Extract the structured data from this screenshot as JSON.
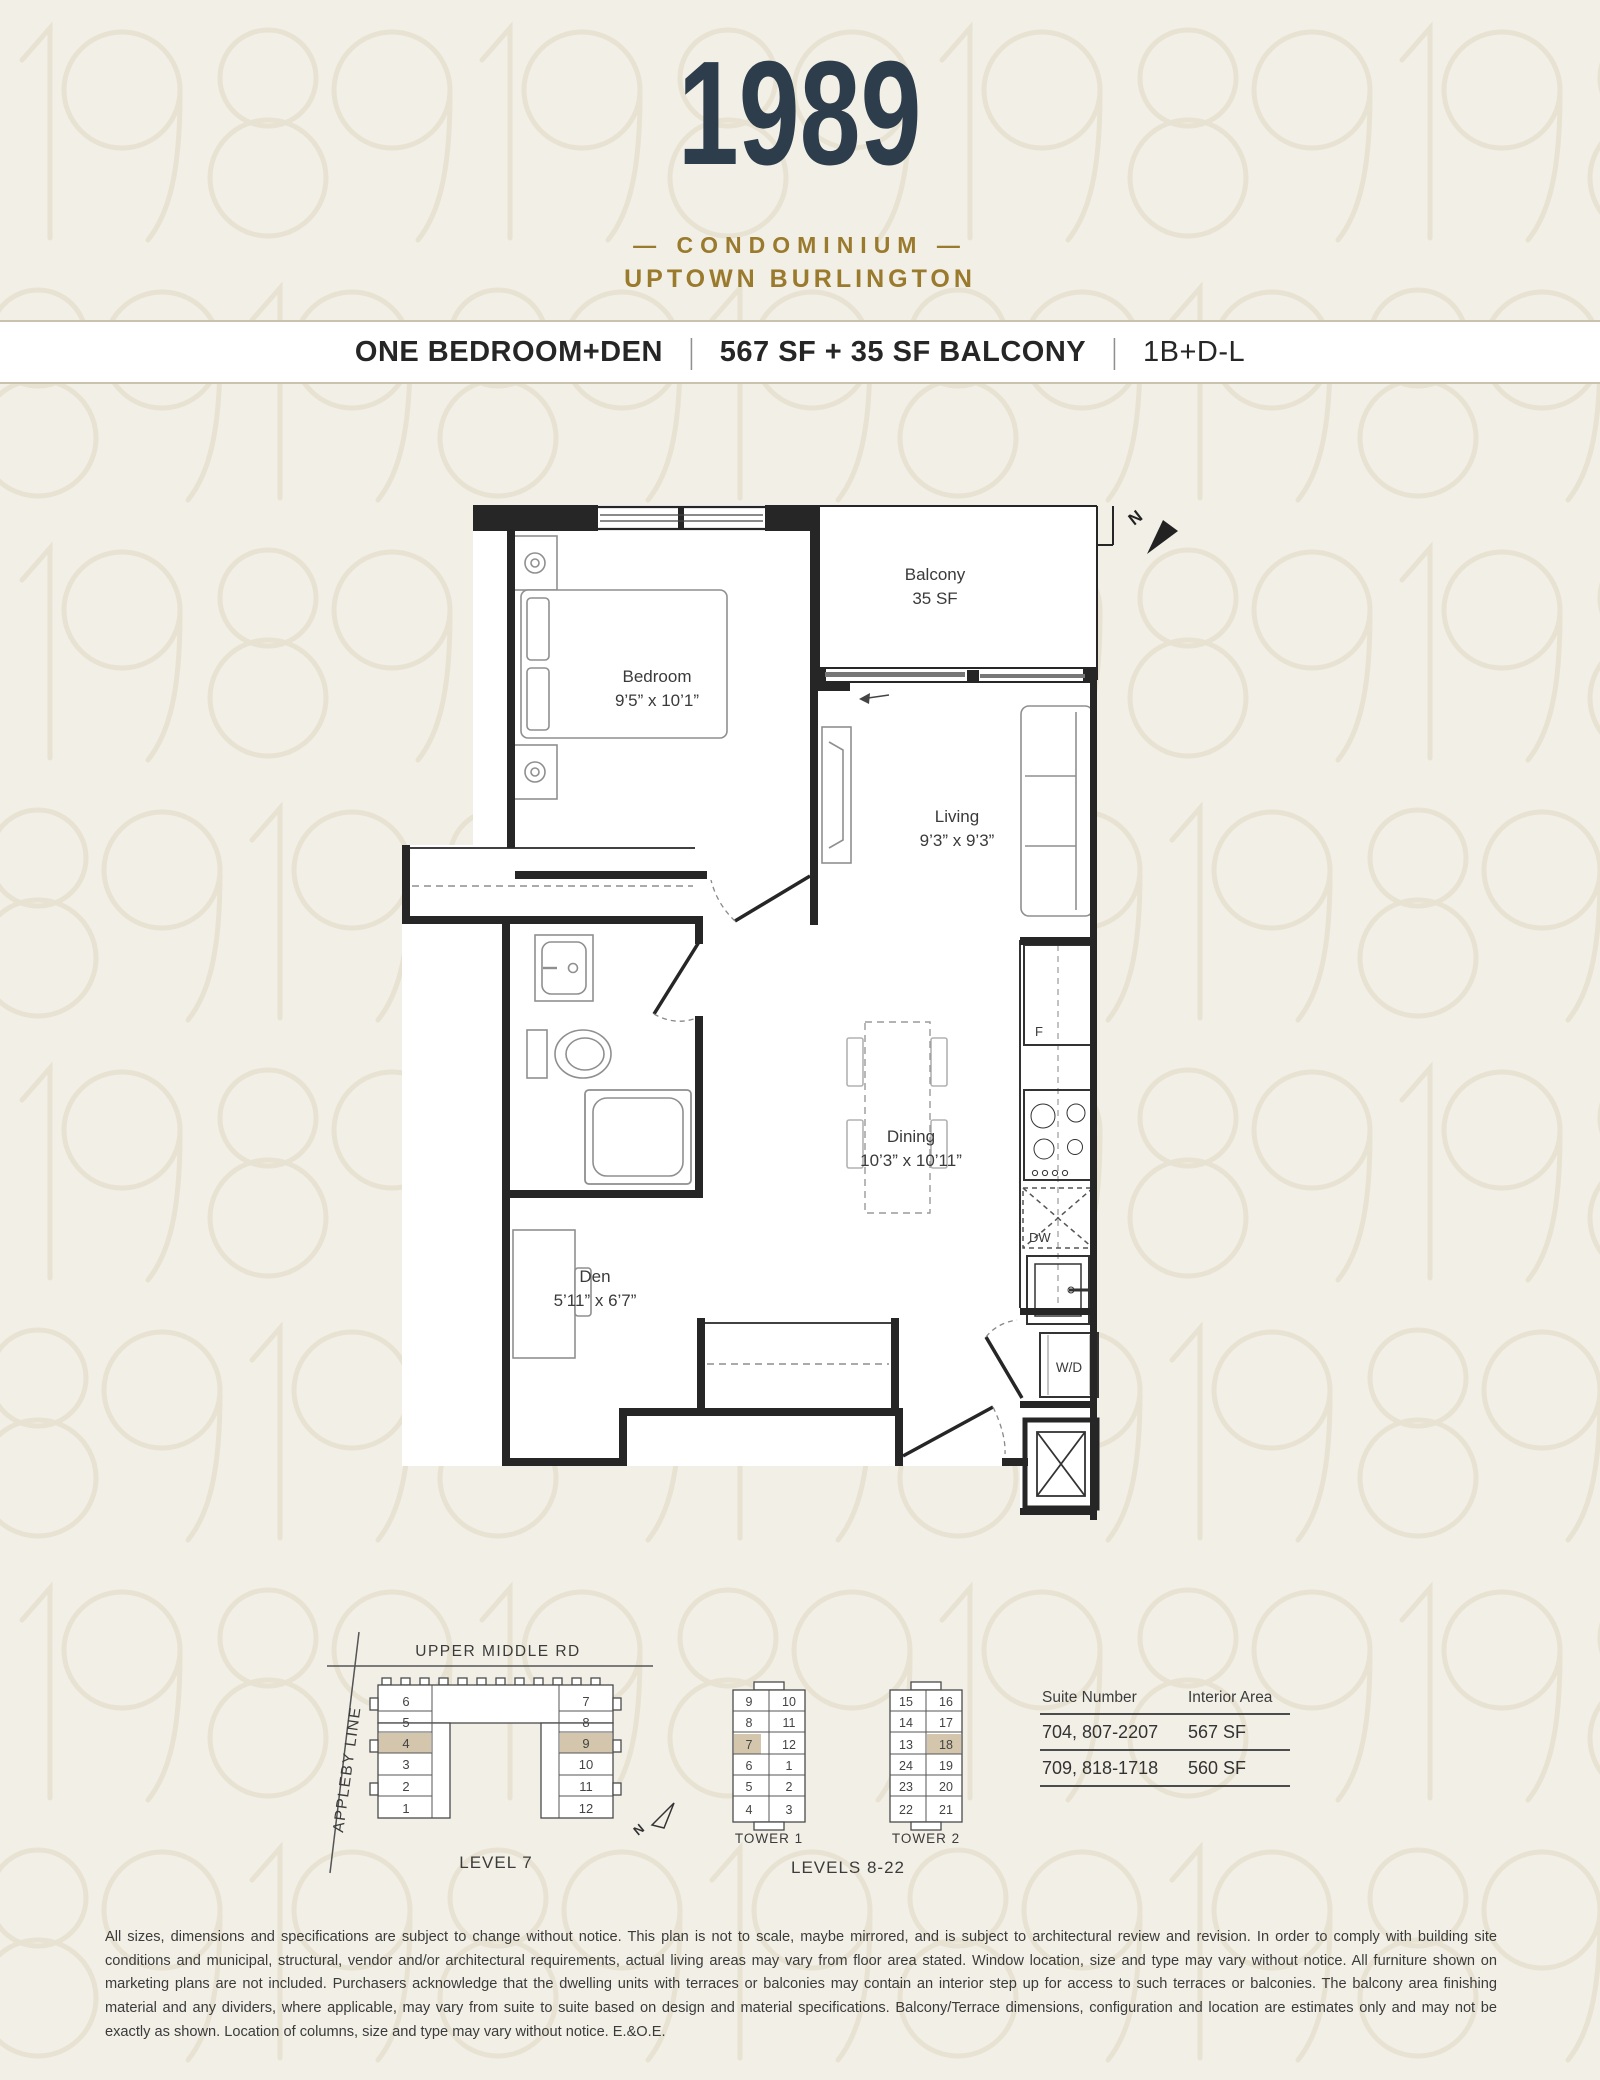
{
  "header": {
    "logo_year": "1989",
    "logo_line1": "— CONDOMINIUM —",
    "logo_line2": "UPTOWN BURLINGTON"
  },
  "title_bar": {
    "plan_name": "ONE BEDROOM+DEN",
    "area": "567 SF + 35 SF BALCONY",
    "plan_code": "1B+D-L",
    "separator": "|"
  },
  "floor_plan": {
    "rooms": {
      "bedroom": {
        "name": "Bedroom",
        "dims": "9’5” x 10’1”"
      },
      "balcony": {
        "name": "Balcony",
        "dims": "35 SF"
      },
      "living": {
        "name": "Living",
        "dims": "9’3” x 9’3”"
      },
      "dining": {
        "name": "Dining",
        "dims": "10’3” x 10’11”"
      },
      "den": {
        "name": "Den",
        "dims": "5’11” x 6’7”"
      }
    },
    "labels": {
      "washer_dryer": "W/D",
      "fridge": "F",
      "dishwasher": "DW",
      "north": "N"
    }
  },
  "key_plans": {
    "level7": {
      "street_top": "UPPER MIDDLE RD",
      "street_left": "APPLEBY LINE",
      "caption": "LEVEL 7",
      "left_suites": [
        "6",
        "5",
        "4",
        "3",
        "2",
        "1"
      ],
      "right_suites": [
        "7",
        "8",
        "9",
        "10",
        "11",
        "12"
      ]
    },
    "tower1": {
      "caption": "TOWER 1",
      "left_suites": [
        "9",
        "8",
        "7",
        "6",
        "5",
        "4"
      ],
      "right_suites": [
        "10",
        "11",
        "12",
        "1",
        "2",
        "3"
      ]
    },
    "tower2": {
      "caption": "TOWER 2",
      "left_suites": [
        "15",
        "14",
        "13",
        "24",
        "23",
        "22"
      ],
      "right_suites": [
        "16",
        "17",
        "18",
        "19",
        "20",
        "21"
      ]
    },
    "levels_caption": "LEVELS 8-22",
    "north": "N"
  },
  "suite_table": {
    "columns": [
      "Suite Number",
      "Interior Area"
    ],
    "rows": [
      [
        "704, 807-2207",
        "567 SF"
      ],
      [
        "709, 818-1718",
        "560 SF"
      ]
    ]
  },
  "disclaimer": "All sizes, dimensions and specifications are subject to change without notice. This plan is not to scale, maybe mirrored, and is subject to architectural review and revision. In order to comply with building site conditions and municipal, structural, vendor and/or architectural requirements, actual living areas may vary from floor area stated. Window location, size and type may vary without notice. All furniture shown on marketing plans are not included. Purchasers acknowledge that the dwelling units with terraces or balconies may contain an interior step up for access to such terraces or balconies. The balcony area finishing material and any dividers, where applicable, may vary from suite to suite based on design and material specifications. Balcony/Terrace dimensions, configuration and location are estimates only and may not be exactly as shown. Location of columns, size and type may vary without notice. E.&O.E.",
  "colors": {
    "background": "#f2efe6",
    "pattern": "#e8e2d2",
    "logo_navy": "#2d3d4c",
    "gold": "#9a7a2c",
    "wall": "#262626",
    "highlight": "#d3c6ac",
    "text_dark": "#2e2e2e"
  }
}
